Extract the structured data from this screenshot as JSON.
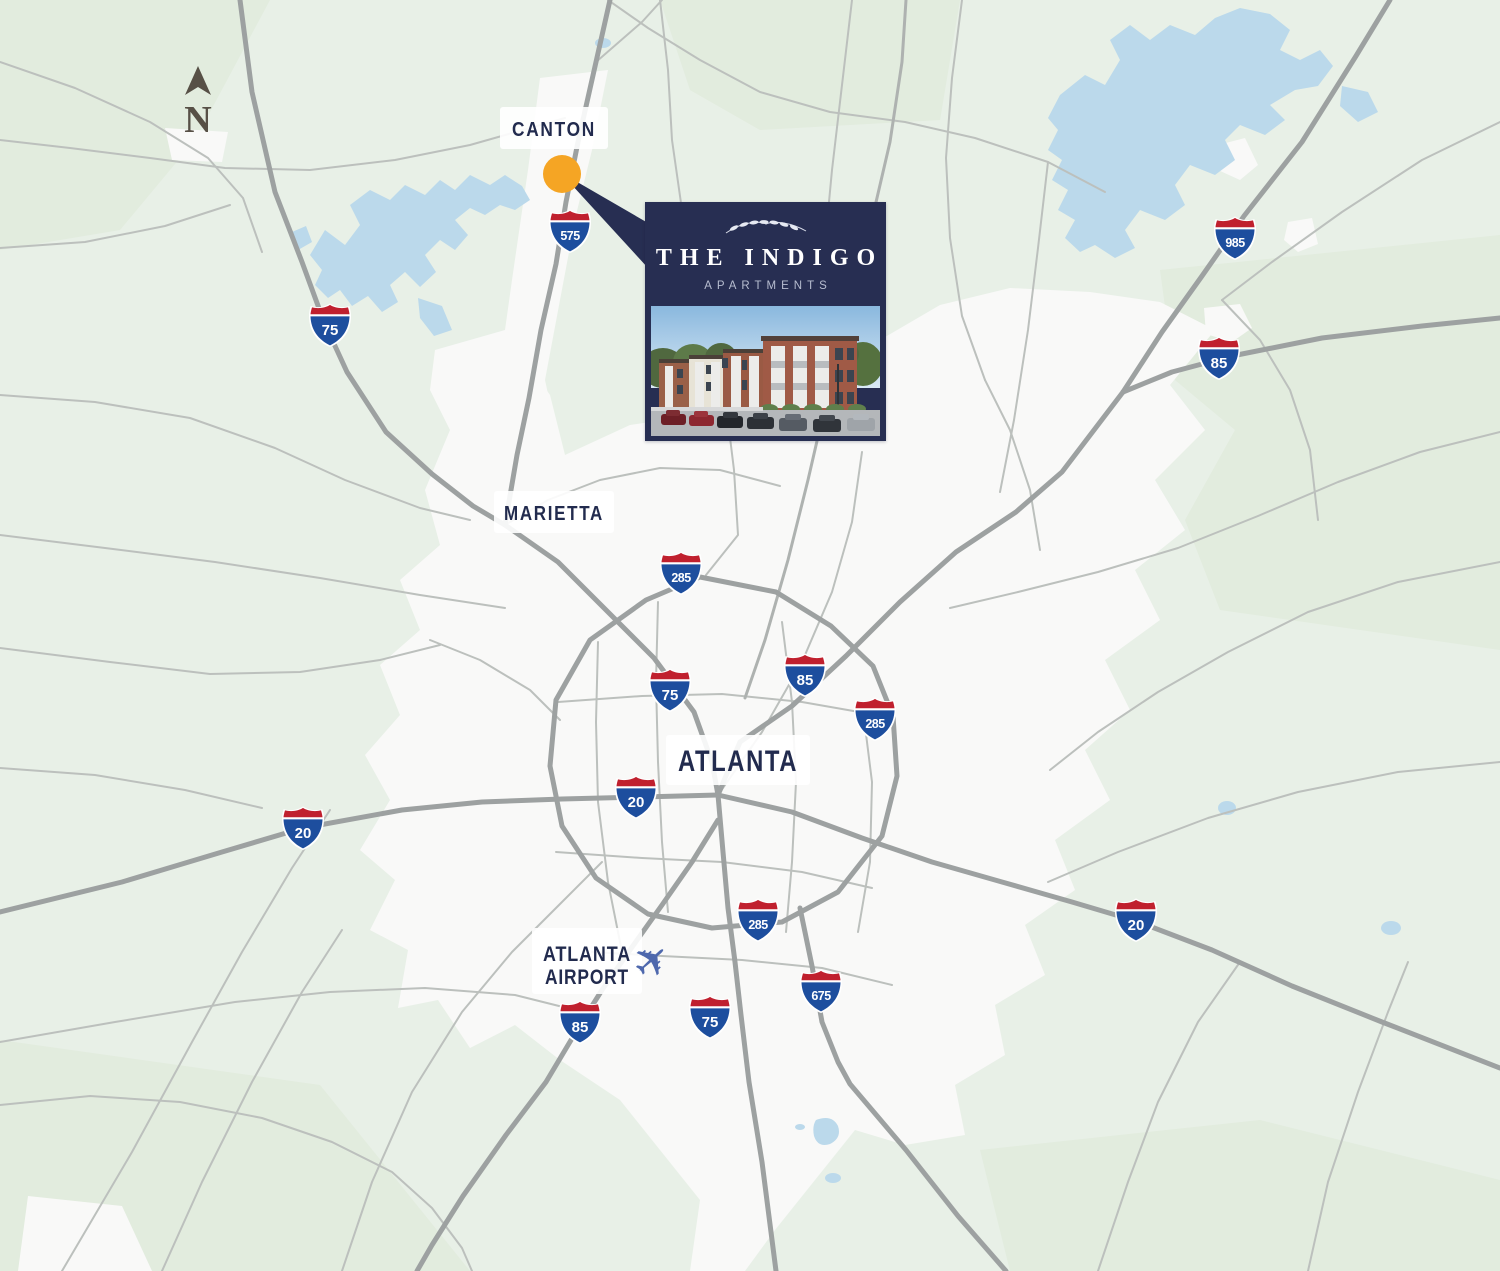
{
  "compass": {
    "label": "N"
  },
  "cities": {
    "canton": "CANTON",
    "marietta": "MARIETTA",
    "atlanta": "ATLANTA",
    "airport_line1": "ATLANTA",
    "airport_line2": "AIRPORT"
  },
  "shields": [
    {
      "route": "575"
    },
    {
      "route": "75"
    },
    {
      "route": "985"
    },
    {
      "route": "85"
    },
    {
      "route": "285"
    },
    {
      "route": "75"
    },
    {
      "route": "85"
    },
    {
      "route": "285"
    },
    {
      "route": "20"
    },
    {
      "route": "20"
    },
    {
      "route": "285"
    },
    {
      "route": "20"
    },
    {
      "route": "675"
    },
    {
      "route": "75"
    },
    {
      "route": "85"
    }
  ],
  "callout": {
    "title": "THE INDIGO",
    "subtitle": "APARTMENTS"
  },
  "icons": {
    "plane": "✈"
  },
  "colors": {
    "background": "#E8F0E7",
    "urban_area": "#F9F9F8",
    "water": "#BBD9EB",
    "road_major": "#9DA1A1",
    "road_minor": "#BCC0BD",
    "navy": "#272E52",
    "marker_orange": "#F5A524",
    "shield_red": "#C0202E",
    "shield_blue": "#1D4E9E",
    "compass_brown": "#575046",
    "plane_blue": "#4E68AD"
  }
}
